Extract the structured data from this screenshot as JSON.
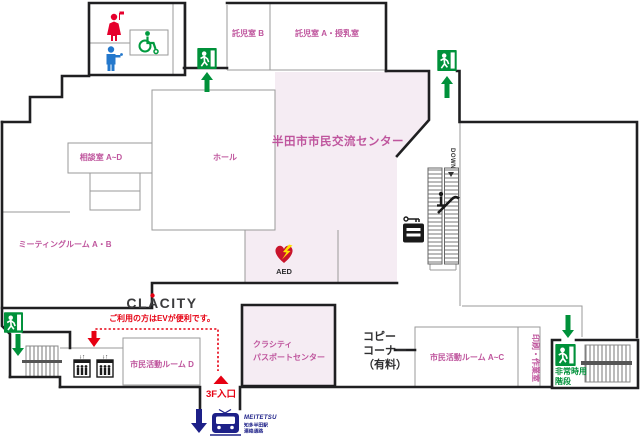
{
  "colors": {
    "pink_fill": "#f5ecf3",
    "pink_text": "#bf559d",
    "accent_green": "#00913a",
    "accent_red": "#e60012",
    "accent_blue": "#1d2088",
    "wall_dark": "#1f1f21"
  },
  "rooms": {
    "nursery_b": "託児室 B",
    "nursery_a": "託児室 A・授乳室",
    "consult": "相談室 A~D",
    "hall": "ホール",
    "center_title": "半田市市民交流センター",
    "meeting": "ミーティングルーム A・B",
    "activity_d": "市民活動ルーム D",
    "passport_line1": "クラシティ",
    "passport_line2": "パスポートセンター",
    "copy_line1": "コピー",
    "copy_line2": "コーナー",
    "copy_line3": "（有料）",
    "activity_ac": "市民活動ルーム A~C",
    "print_room": "印刷・作業室",
    "emergency_line1": "非常時用",
    "emergency_line2": "階段"
  },
  "facility": {
    "aed": "AED",
    "escalator_down": "DOWN",
    "clacity_logo": "CLACITY",
    "ev_note": "ご利用の方はEVが便利です。",
    "entrance_3f": "3F入口",
    "meitetsu_logo": "MEITETSU",
    "station_line1": "知多半田駅",
    "station_line2": "連絡通路",
    "elevator_arrows_left": "↓↑",
    "elevator_arrows_right": "↓↑"
  }
}
